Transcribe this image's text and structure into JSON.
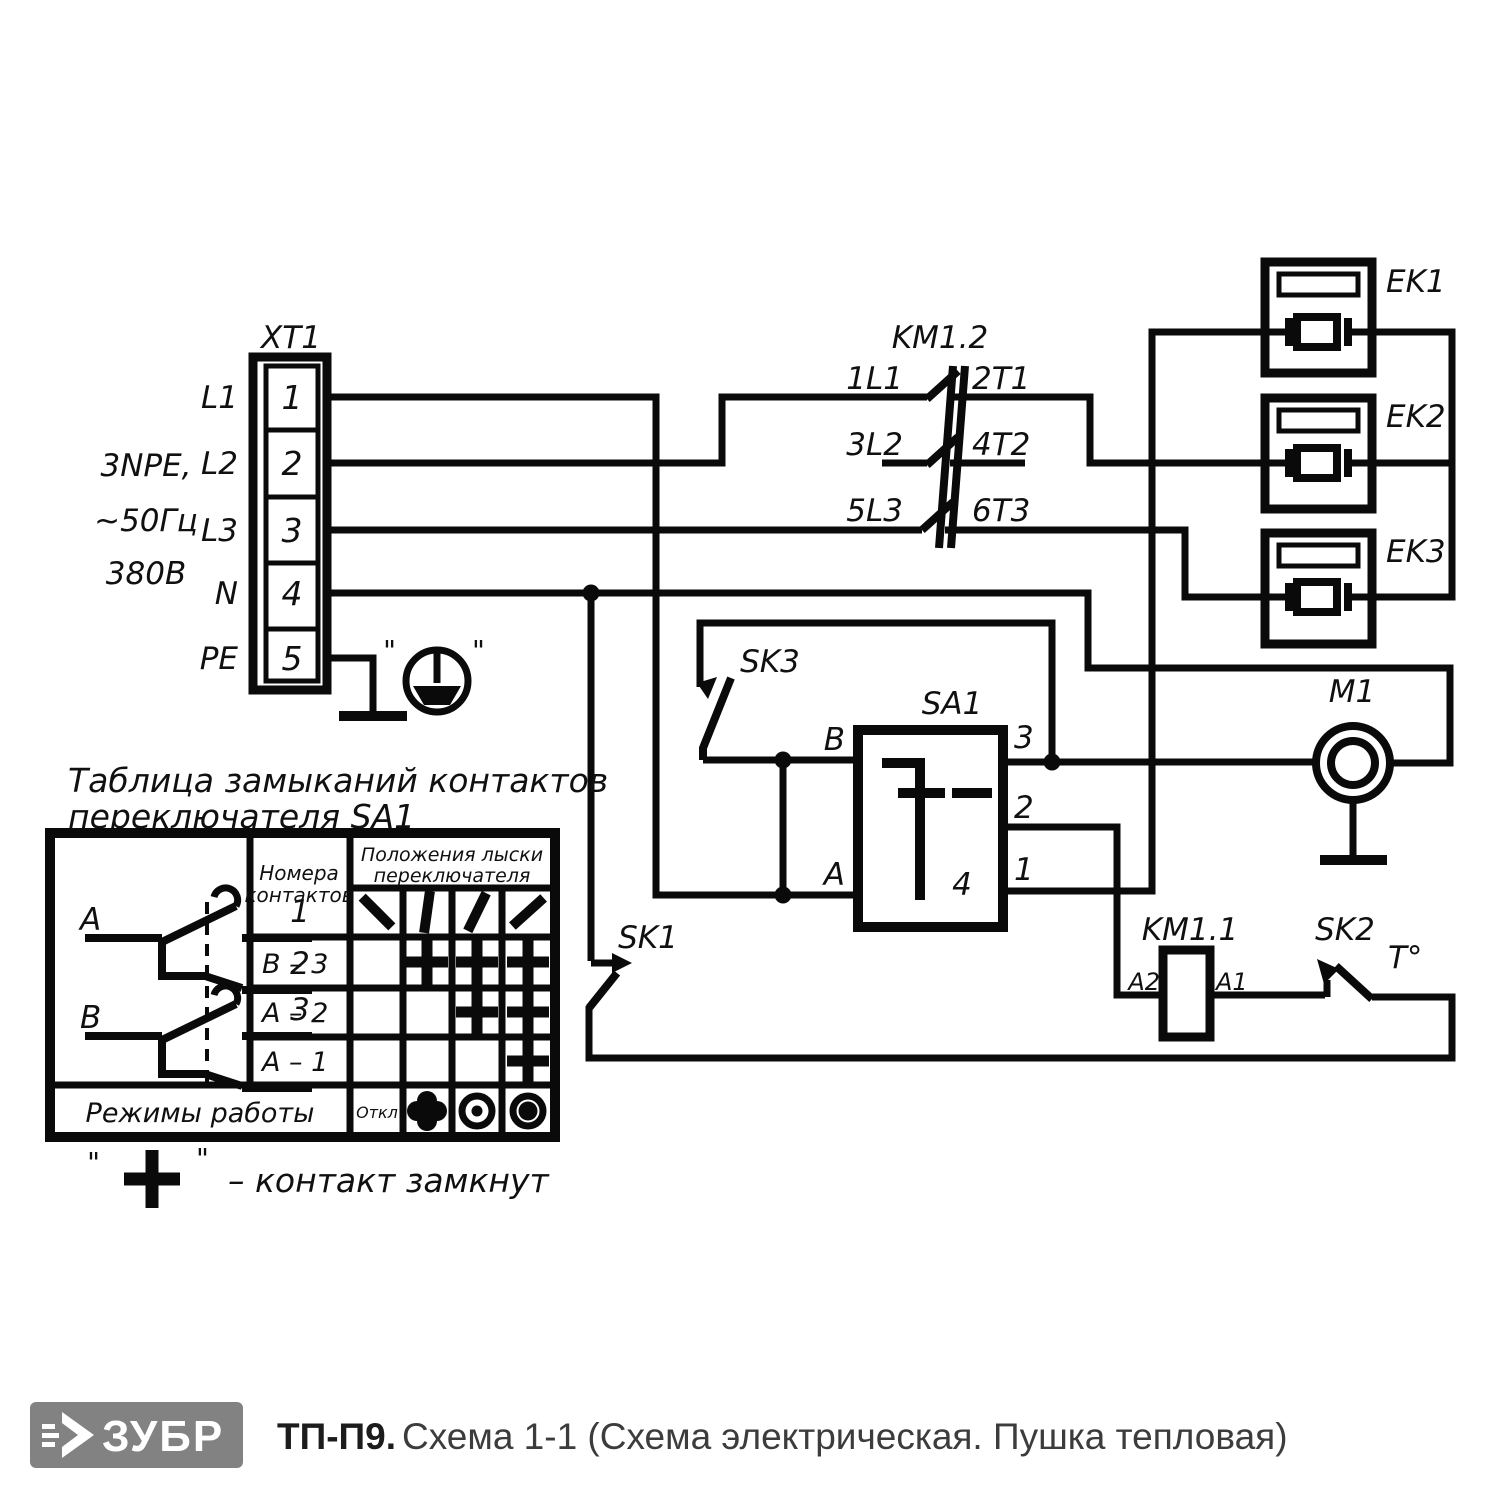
{
  "schematic": {
    "terminal_block": {
      "ref": "XT1",
      "terminals": [
        "1",
        "2",
        "3",
        "4",
        "5"
      ],
      "wires": [
        "L1",
        "L2",
        "L3",
        "N",
        "PE"
      ],
      "supply": [
        "3NPE,",
        "~50Гц",
        "380В"
      ]
    },
    "ground": {
      "quote_left": "\"",
      "quote_right": "\""
    },
    "contactor": {
      "ref": "KM1.2",
      "pole1_in": "1L1",
      "pole1_out": "2T1",
      "pole2_in": "3L2",
      "pole2_out": "4T2",
      "pole3_in": "5L3",
      "pole3_out": "6T3"
    },
    "heaters": {
      "ek1": "EK1",
      "ek2": "EK2",
      "ek3": "EK3"
    },
    "motor": {
      "ref": "M1"
    },
    "mode_switch": {
      "ref": "SA1",
      "t_b": "B",
      "t_a": "A",
      "t3": "3",
      "t2": "2",
      "t1": "1",
      "t4": "4"
    },
    "sk1": {
      "ref": "SK1"
    },
    "sk2": {
      "ref": "SK2",
      "temp": "T°"
    },
    "sk3": {
      "ref": "SK3"
    },
    "coil": {
      "ref": "KM1.1",
      "a2": "A2",
      "a1": "A1"
    }
  },
  "table": {
    "title1": "Таблица замыканий контактов",
    "title2": "переключателя SA1",
    "contacts_hdr1": "Номера",
    "contacts_hdr2": "контактов",
    "positions_hdr1": "Положения лыски",
    "positions_hdr2": "переключателя",
    "off": "Откл",
    "modes": "Режимы работы",
    "rows": [
      {
        "label": "В – 3",
        "closed": [
          0,
          1,
          1,
          1
        ]
      },
      {
        "label": "А – 2",
        "closed": [
          0,
          0,
          1,
          1
        ]
      },
      {
        "label": "А – 1",
        "closed": [
          0,
          0,
          0,
          1
        ]
      }
    ],
    "position_angles": [
      -45,
      8,
      26,
      48
    ],
    "sketch": {
      "a": "A",
      "b": "B",
      "n1": "1",
      "n2": "2",
      "n3": "3"
    }
  },
  "legend": {
    "q": "\"",
    "text": "– контакт замкнут"
  },
  "footer": {
    "brand": "ЗУБР",
    "model": "ТП-П9.",
    "subtitle": "Схема 1-1 (Схема электрическая. Пушка тепловая)"
  }
}
